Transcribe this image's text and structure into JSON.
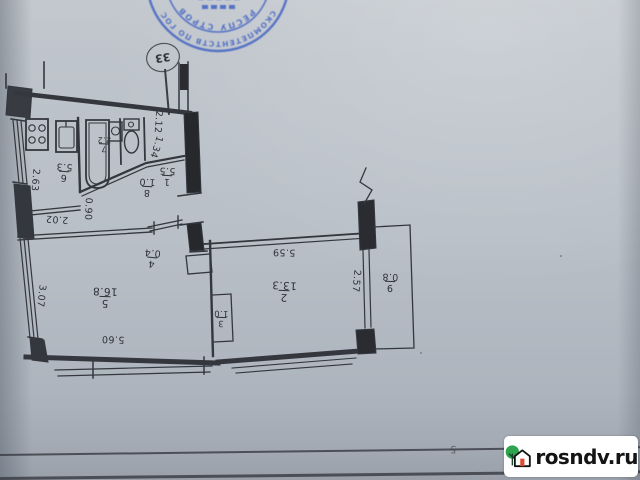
{
  "document": {
    "type_note": "photographed BTI apartment floor plan, drawing appears rotated 180 degrees"
  },
  "stamp": {
    "color": "#3d5fc2",
    "ring_text": "СКОМПЕТЕНТСТВ ПО ГОСУДАРСТВЕННЫМ",
    "inner_text": "РЕСПУ      СТРОВ"
  },
  "marker_oval": {
    "label": "33"
  },
  "plan": {
    "rooms": [
      {
        "id": "r1",
        "number": "1",
        "area": "5.5"
      },
      {
        "id": "r2",
        "number": "2",
        "area": "13.3"
      },
      {
        "id": "r3",
        "number": "3",
        "area": "1.0"
      },
      {
        "id": "r4",
        "number": "4",
        "area": "0.4"
      },
      {
        "id": "r5",
        "number": "5",
        "area": "16.8"
      },
      {
        "id": "r6",
        "number": "6",
        "area": "5.3"
      },
      {
        "id": "r7",
        "number": "7",
        "area": "2.2"
      },
      {
        "id": "r8",
        "number": "8",
        "area": "1.0"
      },
      {
        "id": "r9",
        "number": "9",
        "area": "0.8"
      }
    ],
    "dimensions": [
      {
        "id": "d1",
        "text": "2.63"
      },
      {
        "id": "d2",
        "text": "2.02"
      },
      {
        "id": "d3",
        "text": "0.90"
      },
      {
        "id": "d4",
        "text": "2.12"
      },
      {
        "id": "d5",
        "text": "1.34"
      },
      {
        "id": "d6",
        "text": "3.07"
      },
      {
        "id": "d7",
        "text": "5.60"
      },
      {
        "id": "d8",
        "text": "5.59"
      },
      {
        "id": "d9",
        "text": "2.57"
      }
    ]
  },
  "page_marks": {
    "bottom_left": "5",
    "bottom_right": "н"
  },
  "watermark": {
    "text": "rosndv.ru",
    "tree_color": "#2ea44f",
    "door_color": "#e0482f"
  }
}
